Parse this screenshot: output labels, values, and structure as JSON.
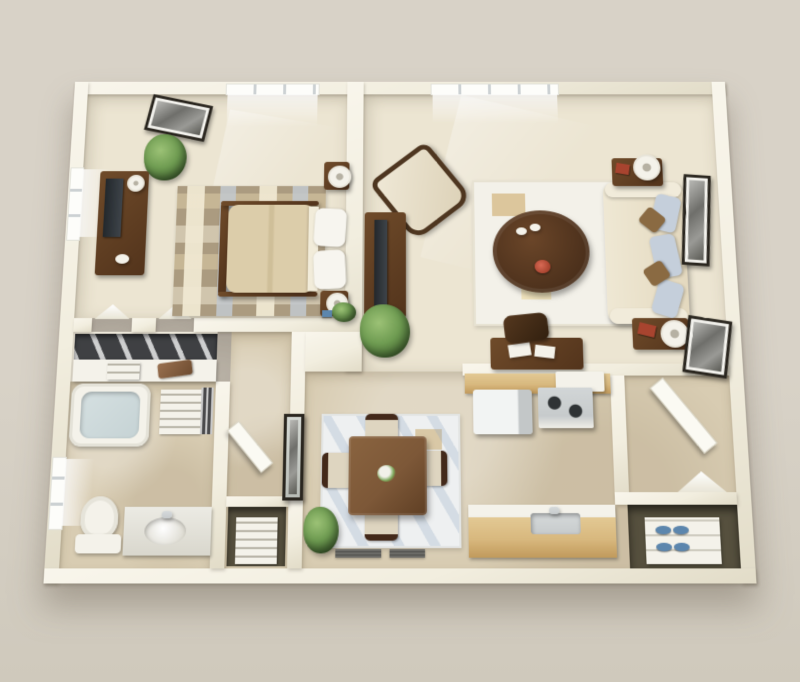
{
  "scene": {
    "type": "3d-floor-plan-rendering",
    "colors": {
      "bg": "#d8d2c7",
      "bg2": "#cfc9bc",
      "wallFace": "#f2eedf",
      "wallBright": "#f9f6ec",
      "wallShade": "#e2dcc8",
      "carpet": "#ece5d2",
      "tile": "#d8ccb2",
      "woodDark": "#53341c",
      "woodMid": "#6f4b2a",
      "woodDining": "#7d5838",
      "maple": "#d8b87e",
      "mapleEdge": "#c19a5c",
      "whiteObj": "#f4f2ea",
      "steel": "#c7cbcc",
      "tvScreen": "#3e444a",
      "duvet": "#dccdaa",
      "pillow": "#f7f5ef",
      "blueCushion": "#c5cfdb",
      "brownPillow": "#8a6a42",
      "water": "#c6d3d5",
      "greenLight": "#6f9c52",
      "greenDark": "#3d5e2c",
      "frameDark": "#2a261f",
      "photoGray": "#9a9a96",
      "rugBedBase": "#ab9b80",
      "rugLivBase": "#f3f1e9",
      "rugDinBase": "#eef0f1",
      "rugTan": "#dcc69c",
      "blueAccent": "#5c86ad",
      "redAccent": "#a8442f",
      "closetDark": "#3f4043",
      "closetFloor": "#56503e"
    },
    "rooms": [
      {
        "id": "bedroom"
      },
      {
        "id": "living-room"
      },
      {
        "id": "closet"
      },
      {
        "id": "bathroom"
      },
      {
        "id": "hallway"
      },
      {
        "id": "dining-area"
      },
      {
        "id": "kitchen"
      },
      {
        "id": "entry"
      }
    ],
    "furniture": [
      "bed",
      "pillows",
      "nightstand",
      "table-lamp",
      "dresser-with-tv",
      "checkered-rug",
      "wall-art",
      "window",
      "potted-plant",
      "armchair",
      "tv-console",
      "sofa",
      "throw-pillows",
      "coffee-table",
      "end-table",
      "area-rug",
      "desk",
      "desk-chair",
      "dining-table",
      "dining-chair",
      "dining-rug",
      "refrigerator",
      "stove",
      "microwave",
      "kitchen-counter",
      "kitchen-sink",
      "bathtub",
      "toilet",
      "vanity-sink",
      "linen-shelf",
      "closet-shelf",
      "storage-basket",
      "drawer-tower",
      "mirror",
      "entry-door",
      "shoe-shelf",
      "shoes",
      "floor-vent",
      "red-book",
      "decor-flowers"
    ]
  }
}
